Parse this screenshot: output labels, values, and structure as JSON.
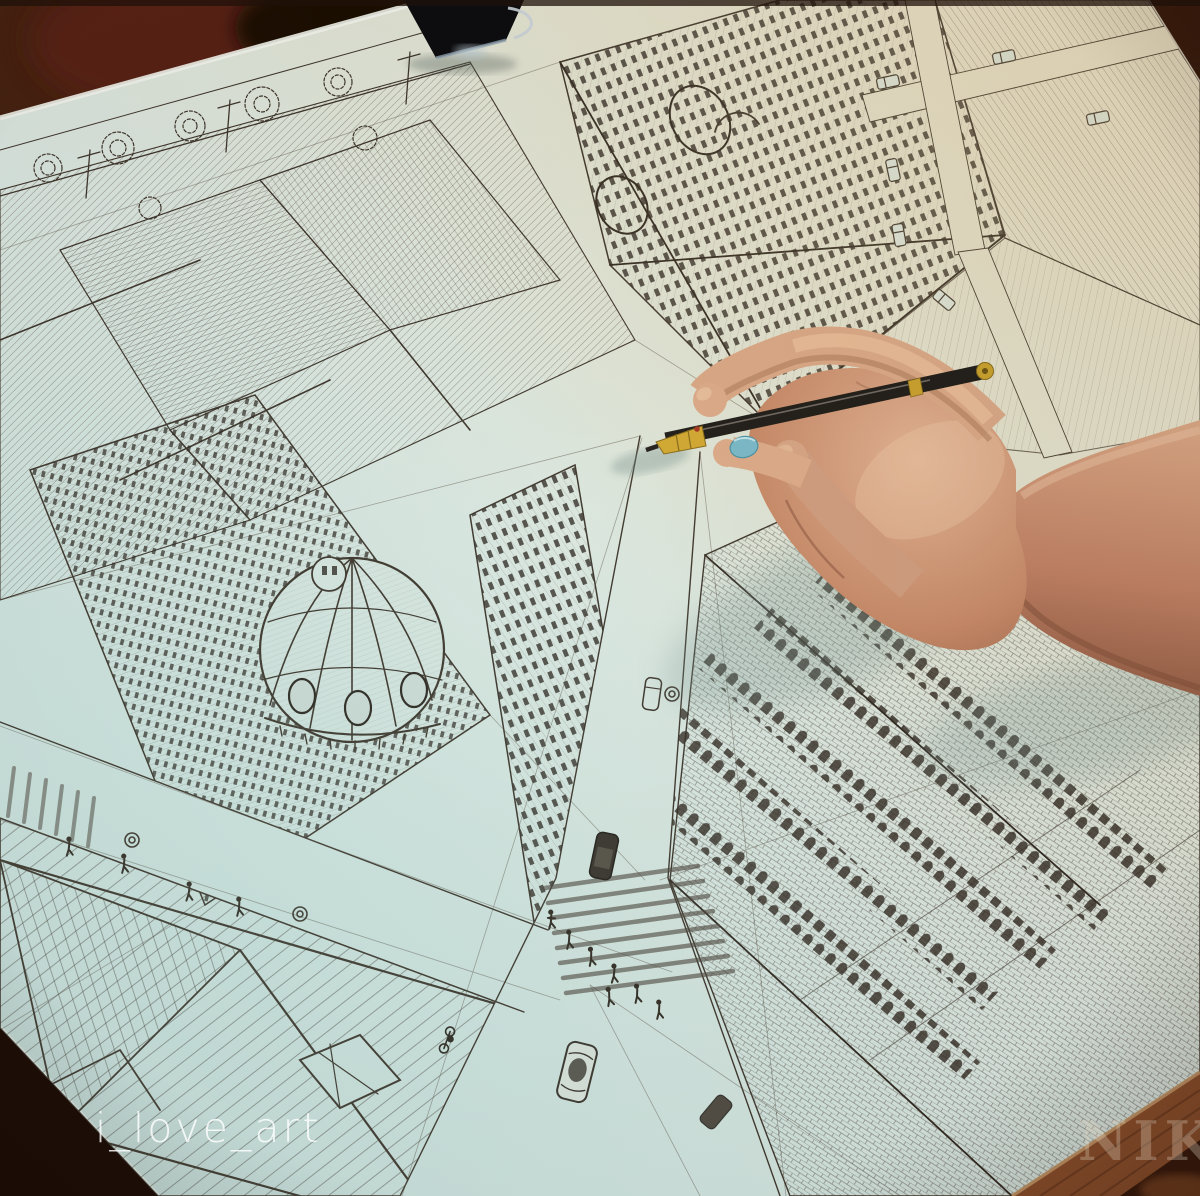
{
  "watermarks": {
    "artist_handle": "i_love_art",
    "corner_text": "NIK"
  },
  "palette": {
    "table_dark_brown": "#2a1409",
    "table_red_brown": "#5c2413",
    "wood_table_edge": "#8c4f2c",
    "paper_warm": "#e8dfc7",
    "paper_cool": "#cfe4df",
    "ink": "#3f362c",
    "skin_light": "#e9c0a0",
    "skin_mid": "#c98f6e",
    "skin_shadow": "#94604a",
    "nail_polish_blue": "#7cb9c6",
    "pen_black": "#24201b",
    "pen_brass": "#c9a12f",
    "binder_clip_black": "#0d0d10"
  }
}
